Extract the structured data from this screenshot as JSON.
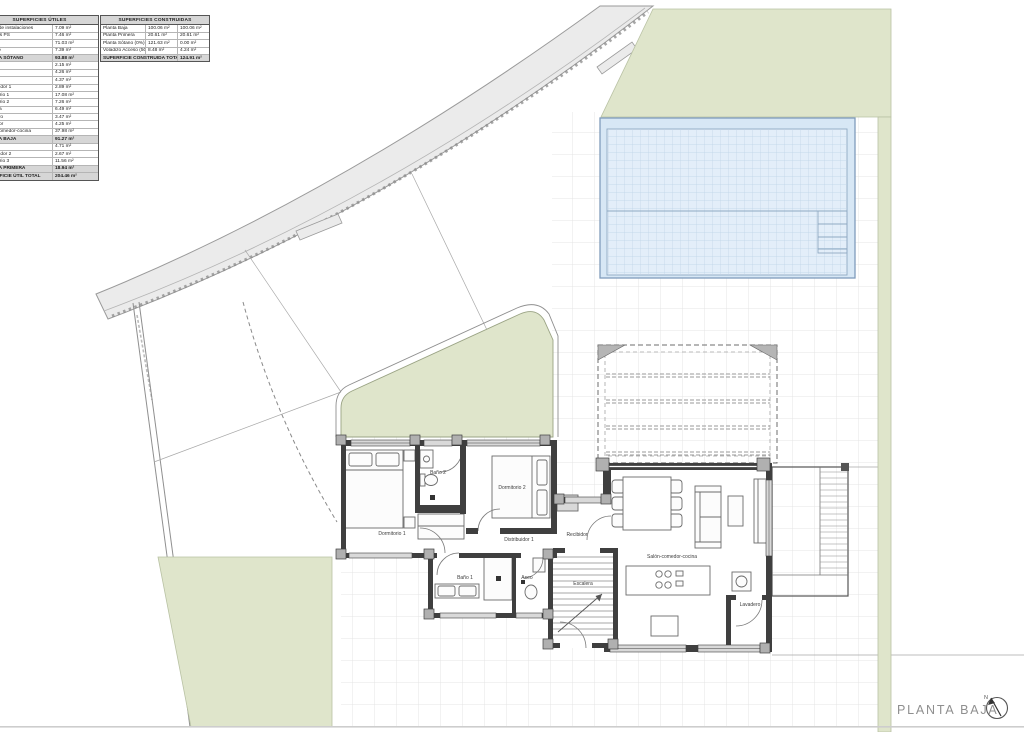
{
  "sheet": {
    "title": "PLANTA BAJA",
    "north_label": "N"
  },
  "tables": {
    "utiles": {
      "header": "SUPERFICIES ÚTILES",
      "rows": [
        {
          "label": "Cuarto de instalaciones",
          "value": "7.09 m²",
          "type": "normal"
        },
        {
          "label": "Calderas PS",
          "value": "7.46 m²",
          "type": "normal"
        },
        {
          "label": "Bodega",
          "value": "71.03 m²",
          "type": "normal"
        },
        {
          "label": "Trastero",
          "value": "7.39 m²",
          "type": "normal"
        },
        {
          "label": "PLANTA SÓTANO",
          "value": "93.88 m²",
          "type": "section"
        },
        {
          "label": "Aseo",
          "value": "2.15 m²",
          "type": "normal"
        },
        {
          "label": "Baño 1",
          "value": "4.26 m²",
          "type": "normal"
        },
        {
          "label": "Baño 2",
          "value": "4.37 m²",
          "type": "normal"
        },
        {
          "label": "Distribuidor 1",
          "value": "2.89 m²",
          "type": "normal"
        },
        {
          "label": "Dormitorio 1",
          "value": "17.08 m²",
          "type": "normal"
        },
        {
          "label": "Dormitorio 2",
          "value": "7.26 m²",
          "type": "normal"
        },
        {
          "label": "Escalera",
          "value": "6.49 m²",
          "type": "normal"
        },
        {
          "label": "Lavadero",
          "value": "3.47 m²",
          "type": "normal"
        },
        {
          "label": "Recibidor",
          "value": "4.25 m²",
          "type": "normal"
        },
        {
          "label": "Salón-comedor-cocina",
          "value": "37.98 m²",
          "type": "normal"
        },
        {
          "label": "PLANTA BAJA",
          "value": "91.27 m²",
          "type": "section"
        },
        {
          "label": "Baño 3",
          "value": "4.71 m²",
          "type": "normal"
        },
        {
          "label": "Distribuidor 2",
          "value": "2.67 m²",
          "type": "normal"
        },
        {
          "label": "Dormitorio 3",
          "value": "11.56 m²",
          "type": "normal"
        },
        {
          "label": "PLANTA PRIMERA",
          "value": "18.94 m²",
          "type": "section"
        },
        {
          "label": "SUPERFICIE ÚTIL TOTAL",
          "value": "204.46 m²",
          "type": "total"
        }
      ]
    },
    "construidas": {
      "header": "SUPERFICIES CONSTRUIDAS",
      "rows": [
        {
          "label": "Planta Baja",
          "v1": "100.06 m²",
          "v2": "100.06 m²"
        },
        {
          "label": "Planta Primera",
          "v1": "20.61 m²",
          "v2": "20.61 m²"
        },
        {
          "label": "Planta Sótano (0%)",
          "v1": "121.63 m²",
          "v2": "0.00 m²"
        },
        {
          "label": "Voladizo Acceso (50%)",
          "v1": "8.48 m²",
          "v2": "4.24 m²"
        }
      ],
      "total": {
        "label": "SUPERFICIE CONSTRUIDA TOTAL",
        "value": "124.91 m²"
      }
    }
  },
  "plan": {
    "rooms": [
      "Dormitorio 1",
      "Baño 2",
      "Dormitorio 2",
      "Distribuidor 1",
      "Recibidor",
      "Baño 1",
      "Aseo",
      "Escalera",
      "Salón-comedor-cocina",
      "Lavadero"
    ]
  },
  "colors": {
    "green": "#dfe5cb",
    "pool_fill": "#d7e7f5",
    "pool_grid": "#bdd3e7",
    "road": "#ebebeb",
    "wall": "#3f3f3f",
    "terrace_grid": "#e4e4e4"
  }
}
